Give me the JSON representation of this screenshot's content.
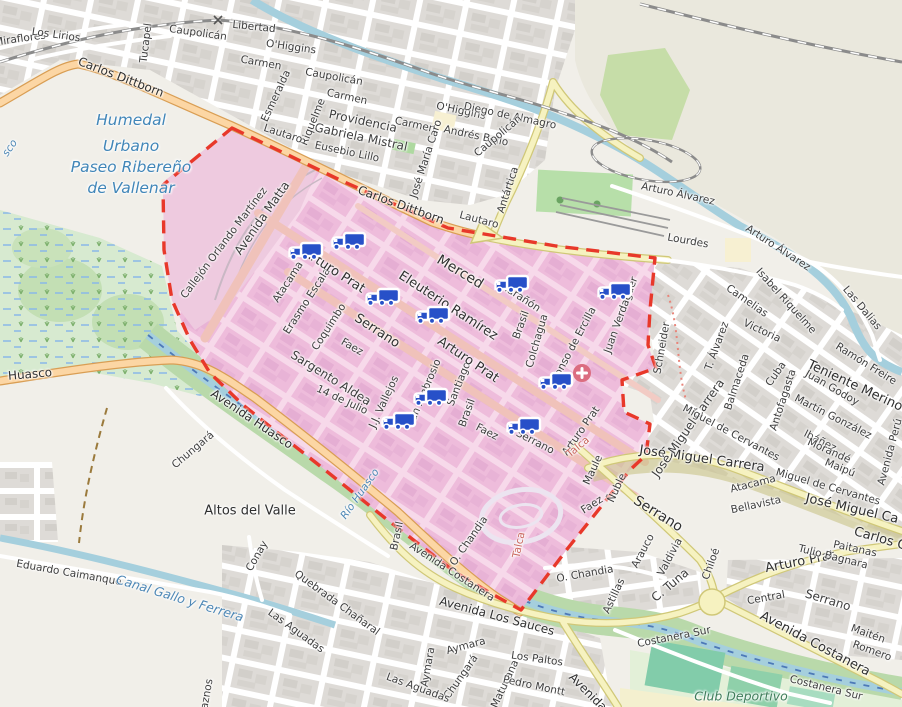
{
  "map": {
    "zone": {
      "name": "highlighted delivery zone",
      "border_color": "#e8382a",
      "fill": "#efc0da"
    },
    "icons": {
      "truck_color": "#2750c8",
      "hospital_color": "#db6d80"
    },
    "pois": [
      {
        "type": "hospital",
        "x": 582,
        "y": 373
      }
    ],
    "trucks": [
      {
        "x": 305,
        "y": 252
      },
      {
        "x": 348,
        "y": 242
      },
      {
        "x": 382,
        "y": 298
      },
      {
        "x": 432,
        "y": 316
      },
      {
        "x": 511,
        "y": 285
      },
      {
        "x": 614,
        "y": 292
      },
      {
        "x": 555,
        "y": 382
      },
      {
        "x": 430,
        "y": 398
      },
      {
        "x": 398,
        "y": 422
      },
      {
        "x": 523,
        "y": 427
      }
    ],
    "labels": [
      {
        "t": "Miraflores",
        "x": 20,
        "y": 39,
        "r": -8,
        "c": "st"
      },
      {
        "t": "Los Lirios",
        "x": 56,
        "y": 35,
        "r": 8,
        "c": "st"
      },
      {
        "t": "Carlos Dittborn",
        "x": 121,
        "y": 77,
        "r": 21,
        "c": "maj",
        "s": 12
      },
      {
        "t": "Tucapel",
        "x": 146,
        "y": 43,
        "r": -83,
        "c": "st"
      },
      {
        "t": "Caupolicán",
        "x": 198,
        "y": 33,
        "r": 8,
        "c": "st"
      },
      {
        "t": "Libertad",
        "x": 254,
        "y": 27,
        "r": 6,
        "c": "st"
      },
      {
        "t": "O'Higgins",
        "x": 291,
        "y": 47,
        "r": 8,
        "c": "st"
      },
      {
        "t": "Carmen",
        "x": 261,
        "y": 63,
        "r": 10,
        "c": "st"
      },
      {
        "t": "Esmeralda",
        "x": 276,
        "y": 96,
        "r": -65,
        "c": "st"
      },
      {
        "t": "Caupolicán",
        "x": 334,
        "y": 77,
        "r": 10,
        "c": "st"
      },
      {
        "t": "Carmen",
        "x": 347,
        "y": 97,
        "r": 12,
        "c": "st"
      },
      {
        "t": "Providencia",
        "x": 363,
        "y": 121,
        "r": 12,
        "c": "st",
        "s": 12
      },
      {
        "t": "Gabriela Mistral",
        "x": 361,
        "y": 137,
        "r": 12,
        "c": "st",
        "s": 12
      },
      {
        "t": "Eusebio Lillo",
        "x": 347,
        "y": 152,
        "r": 12,
        "c": "st"
      },
      {
        "t": "Riquelme",
        "x": 313,
        "y": 122,
        "r": -68,
        "c": "st"
      },
      {
        "t": "Carmen",
        "x": 415,
        "y": 125,
        "r": 12,
        "c": "st"
      },
      {
        "t": "José María Caro",
        "x": 426,
        "y": 159,
        "r": -72,
        "c": "st"
      },
      {
        "t": "O'Higgins",
        "x": 461,
        "y": 111,
        "r": 12,
        "c": "st"
      },
      {
        "t": "Diego de Almagro",
        "x": 510,
        "y": 116,
        "r": 12,
        "c": "st"
      },
      {
        "t": "Andrés Bello",
        "x": 476,
        "y": 136,
        "r": 12,
        "c": "st"
      },
      {
        "t": "Caupolicán",
        "x": 498,
        "y": 136,
        "r": -40,
        "c": "st"
      },
      {
        "t": "Antártica",
        "x": 508,
        "y": 190,
        "r": -72,
        "c": "st"
      },
      {
        "t": "Lautaro",
        "x": 283,
        "y": 134,
        "r": 18,
        "c": "st"
      },
      {
        "t": "Lautaro",
        "x": 479,
        "y": 220,
        "r": 15,
        "c": "st"
      },
      {
        "t": "Carlos Dittborn",
        "x": 401,
        "y": 205,
        "r": 20,
        "c": "maj",
        "s": 12
      },
      {
        "t": "Arturo Álvarez",
        "x": 678,
        "y": 194,
        "r": 12,
        "c": "st"
      },
      {
        "t": "Arturo Álvarez",
        "x": 778,
        "y": 248,
        "r": 33,
        "c": "st"
      },
      {
        "t": "Lourdes",
        "x": 688,
        "y": 241,
        "r": 10,
        "c": "st"
      },
      {
        "t": "Humedal",
        "x": 131,
        "y": 120,
        "r": 0,
        "c": "hum"
      },
      {
        "t": "Urbano",
        "x": 131,
        "y": 146,
        "r": 0,
        "c": "hum"
      },
      {
        "t": "Paseo Ribereño",
        "x": 131,
        "y": 167,
        "r": 0,
        "c": "hum"
      },
      {
        "t": "de Vallenar",
        "x": 131,
        "y": 188,
        "r": 0,
        "c": "hum"
      },
      {
        "t": "sco",
        "x": 10,
        "y": 148,
        "r": -55,
        "c": "wat"
      },
      {
        "t": "Avenida Matta",
        "x": 262,
        "y": 218,
        "r": -55,
        "c": "st",
        "s": 12
      },
      {
        "t": "Callejón Orlando Martínez",
        "x": 224,
        "y": 243,
        "r": -53,
        "c": "st",
        "s": 10.5
      },
      {
        "t": "Atacama",
        "x": 288,
        "y": 282,
        "r": -57,
        "c": "st"
      },
      {
        "t": "Erasmo Escala",
        "x": 307,
        "y": 301,
        "r": -57,
        "c": "st",
        "s": 10.5
      },
      {
        "t": "Coquimbo",
        "x": 329,
        "y": 327,
        "r": -57,
        "c": "st"
      },
      {
        "t": "Arturo Prat",
        "x": 334,
        "y": 271,
        "r": 33,
        "c": "maj"
      },
      {
        "t": "Serrano",
        "x": 377,
        "y": 331,
        "r": 33,
        "c": "maj"
      },
      {
        "t": "Faez",
        "x": 352,
        "y": 347,
        "r": 30,
        "c": "st"
      },
      {
        "t": "Sargento Aldea",
        "x": 331,
        "y": 378,
        "r": 32,
        "c": "st",
        "s": 12
      },
      {
        "t": "14 de Julio",
        "x": 342,
        "y": 400,
        "r": 25,
        "c": "st",
        "s": 10.5
      },
      {
        "t": "J.J. Vallejos",
        "x": 384,
        "y": 402,
        "r": -65,
        "c": "st"
      },
      {
        "t": "San Ambrosio",
        "x": 424,
        "y": 393,
        "r": -67,
        "c": "st"
      },
      {
        "t": "Santiago",
        "x": 459,
        "y": 384,
        "r": -68,
        "c": "st",
        "s": 10.5
      },
      {
        "t": "Merced",
        "x": 460,
        "y": 272,
        "r": 31,
        "c": "maj",
        "s": 14
      },
      {
        "t": "Eleuterio Ramírez",
        "x": 448,
        "y": 306,
        "r": 33,
        "c": "maj"
      },
      {
        "t": "Marañón",
        "x": 520,
        "y": 297,
        "r": 33,
        "c": "st",
        "s": 10.5
      },
      {
        "t": "Brasil",
        "x": 521,
        "y": 325,
        "r": -70,
        "c": "st"
      },
      {
        "t": "Brasil",
        "x": 467,
        "y": 413,
        "r": -70,
        "c": "st"
      },
      {
        "t": "Brasil",
        "x": 397,
        "y": 536,
        "r": -78,
        "c": "st"
      },
      {
        "t": "Arturo Prat",
        "x": 468,
        "y": 360,
        "r": 34,
        "c": "maj"
      },
      {
        "t": "Colchagua",
        "x": 537,
        "y": 341,
        "r": -74,
        "c": "st"
      },
      {
        "t": "Alonso de Ercilla",
        "x": 573,
        "y": 346,
        "r": -62,
        "c": "st"
      },
      {
        "t": "Juan Verdaguer",
        "x": 621,
        "y": 315,
        "r": -70,
        "c": "st"
      },
      {
        "t": "Faez",
        "x": 487,
        "y": 432,
        "r": 27,
        "c": "st"
      },
      {
        "t": "Serrano",
        "x": 535,
        "y": 442,
        "r": 27,
        "c": "st"
      },
      {
        "t": "Arturo Prat",
        "x": 581,
        "y": 431,
        "r": -55,
        "c": "st"
      },
      {
        "t": "O. Chandia",
        "x": 469,
        "y": 541,
        "r": -55,
        "c": "st"
      },
      {
        "t": "Talca",
        "x": 578,
        "y": 447,
        "r": -40,
        "c": "red"
      },
      {
        "t": "Talca",
        "x": 519,
        "y": 545,
        "r": -78,
        "c": "red"
      },
      {
        "t": "Avenida Costanera",
        "x": 452,
        "y": 572,
        "r": 33,
        "c": "st"
      },
      {
        "t": "Río Huasco",
        "x": 360,
        "y": 494,
        "r": -55,
        "c": "wat"
      },
      {
        "t": "Eduardo Caimanque",
        "x": 69,
        "y": 573,
        "r": 10,
        "c": "st"
      },
      {
        "t": "Canal Gallo y Ferrera",
        "x": 180,
        "y": 598,
        "r": 17,
        "c": "wat",
        "s": 12.5
      },
      {
        "t": "Altos del Valle",
        "x": 250,
        "y": 511,
        "r": 0,
        "c": "pl"
      },
      {
        "t": "Huasco",
        "x": 30,
        "y": 374,
        "r": -5,
        "c": "maj",
        "s": 12
      },
      {
        "t": "Avenida Huasco",
        "x": 252,
        "y": 419,
        "r": 34,
        "c": "maj",
        "s": 12
      },
      {
        "t": "Chungará",
        "x": 193,
        "y": 450,
        "r": -40,
        "c": "st"
      },
      {
        "t": "Chungará",
        "x": 461,
        "y": 677,
        "r": -55,
        "c": "st"
      },
      {
        "t": "Conay",
        "x": 257,
        "y": 556,
        "r": -60,
        "c": "st"
      },
      {
        "t": "Quebrada Chañaral",
        "x": 337,
        "y": 603,
        "r": 36,
        "c": "st"
      },
      {
        "t": "Las Aguadas",
        "x": 296,
        "y": 631,
        "r": 36,
        "c": "st"
      },
      {
        "t": "Las Aguadas",
        "x": 418,
        "y": 688,
        "r": 20,
        "c": "st"
      },
      {
        "t": "aznos",
        "x": 207,
        "y": 694,
        "r": -80,
        "c": "st"
      },
      {
        "t": "Aymara",
        "x": 466,
        "y": 646,
        "r": -15,
        "c": "st"
      },
      {
        "t": "Aymara",
        "x": 428,
        "y": 667,
        "r": -80,
        "c": "st"
      },
      {
        "t": "Matucana",
        "x": 505,
        "y": 684,
        "r": -65,
        "c": "st"
      },
      {
        "t": "Pedro Montt",
        "x": 534,
        "y": 686,
        "r": 12,
        "c": "st"
      },
      {
        "t": "Los Paltos",
        "x": 537,
        "y": 659,
        "r": 8,
        "c": "st"
      },
      {
        "t": "Avenida Los Sauces",
        "x": 497,
        "y": 616,
        "r": 15,
        "c": "maj",
        "s": 12
      },
      {
        "t": "Avenida",
        "x": 588,
        "y": 692,
        "r": 45,
        "c": "maj",
        "s": 12
      },
      {
        "t": "O. Chandia",
        "x": 585,
        "y": 574,
        "r": -10,
        "c": "st"
      },
      {
        "t": "Astillas",
        "x": 614,
        "y": 596,
        "r": -65,
        "c": "st"
      },
      {
        "t": "C. Tuna",
        "x": 670,
        "y": 585,
        "r": -40,
        "c": "st",
        "s": 12
      },
      {
        "t": "Arauco",
        "x": 643,
        "y": 551,
        "r": -62,
        "c": "st"
      },
      {
        "t": "Valdivia",
        "x": 670,
        "y": 557,
        "r": -62,
        "c": "st"
      },
      {
        "t": "Chiloé",
        "x": 711,
        "y": 564,
        "r": -70,
        "c": "st"
      },
      {
        "t": "Maule",
        "x": 593,
        "y": 470,
        "r": -65,
        "c": "st"
      },
      {
        "t": "Ñuble",
        "x": 617,
        "y": 488,
        "r": -65,
        "c": "st"
      },
      {
        "t": "Faez",
        "x": 592,
        "y": 505,
        "r": -33,
        "c": "st"
      },
      {
        "t": "Serrano",
        "x": 658,
        "y": 514,
        "r": 32,
        "c": "maj",
        "s": 14
      },
      {
        "t": "Atacama",
        "x": 753,
        "y": 484,
        "r": -14,
        "c": "st"
      },
      {
        "t": "Bellavista",
        "x": 756,
        "y": 505,
        "r": -12,
        "c": "st"
      },
      {
        "t": "José Miguel Carrera",
        "x": 702,
        "y": 459,
        "r": 8,
        "c": "maj"
      },
      {
        "t": "José Miguel Ca",
        "x": 852,
        "y": 509,
        "r": 13,
        "c": "maj"
      },
      {
        "t": "Carlos Co",
        "x": 884,
        "y": 540,
        "r": 16,
        "c": "maj"
      },
      {
        "t": "Arturo Prat",
        "x": 800,
        "y": 562,
        "r": -11,
        "c": "maj"
      },
      {
        "t": "Tulio Bagnara",
        "x": 833,
        "y": 557,
        "r": 14,
        "c": "st"
      },
      {
        "t": "Paitanas",
        "x": 855,
        "y": 549,
        "r": 12,
        "c": "st"
      },
      {
        "t": "Serrano",
        "x": 828,
        "y": 600,
        "r": 17,
        "c": "st",
        "s": 12
      },
      {
        "t": "Central",
        "x": 766,
        "y": 598,
        "r": -10,
        "c": "st"
      },
      {
        "t": "Maitén",
        "x": 868,
        "y": 634,
        "r": 20,
        "c": "st"
      },
      {
        "t": "Romero",
        "x": 872,
        "y": 651,
        "r": 20,
        "c": "st"
      },
      {
        "t": "Avenida Costanera",
        "x": 815,
        "y": 644,
        "r": 28,
        "c": "maj"
      },
      {
        "t": "Costanera Sur",
        "x": 674,
        "y": 637,
        "r": -11,
        "c": "st"
      },
      {
        "t": "Costanera Sur",
        "x": 826,
        "y": 688,
        "r": 14,
        "c": "st"
      },
      {
        "t": "Club Deportivo",
        "x": 741,
        "y": 696,
        "r": 0,
        "c": "lei"
      },
      {
        "t": "Schneider",
        "x": 662,
        "y": 348,
        "r": -80,
        "c": "st"
      },
      {
        "t": "José Miguel Carrera",
        "x": 688,
        "y": 428,
        "r": -55,
        "c": "st",
        "s": 12
      },
      {
        "t": "T. Álvarez",
        "x": 717,
        "y": 346,
        "r": -70,
        "c": "st"
      },
      {
        "t": "Camelias",
        "x": 747,
        "y": 301,
        "r": 35,
        "c": "st"
      },
      {
        "t": "Victoria",
        "x": 762,
        "y": 331,
        "r": 25,
        "c": "st"
      },
      {
        "t": "Isabel Riquelme",
        "x": 786,
        "y": 301,
        "r": 48,
        "c": "st"
      },
      {
        "t": "Las Dalias",
        "x": 862,
        "y": 308,
        "r": 50,
        "c": "st"
      },
      {
        "t": "Ramón Freire",
        "x": 866,
        "y": 364,
        "r": 32,
        "c": "st"
      },
      {
        "t": "Teniente Merino",
        "x": 855,
        "y": 386,
        "r": 25,
        "c": "maj"
      },
      {
        "t": "Balmaceda",
        "x": 737,
        "y": 382,
        "r": -72,
        "c": "st"
      },
      {
        "t": "Cuba",
        "x": 776,
        "y": 374,
        "r": -55,
        "c": "st"
      },
      {
        "t": "Antofagasta",
        "x": 783,
        "y": 400,
        "r": -72,
        "c": "st"
      },
      {
        "t": "Juan Godoy",
        "x": 832,
        "y": 388,
        "r": 30,
        "c": "st"
      },
      {
        "t": "Martín González",
        "x": 833,
        "y": 417,
        "r": 27,
        "c": "st"
      },
      {
        "t": "Ibáñez",
        "x": 820,
        "y": 441,
        "r": 27,
        "c": "st"
      },
      {
        "t": "Morandé",
        "x": 829,
        "y": 451,
        "r": 24,
        "c": "st"
      },
      {
        "t": "Maipú",
        "x": 840,
        "y": 468,
        "r": 22,
        "c": "st"
      },
      {
        "t": "Miguel de Cervantes",
        "x": 828,
        "y": 487,
        "r": 16,
        "c": "st"
      },
      {
        "t": "Miguel de Cervantes",
        "x": 731,
        "y": 433,
        "r": 28,
        "c": "st"
      },
      {
        "t": "Avenida Perú",
        "x": 890,
        "y": 452,
        "r": -75,
        "c": "st"
      }
    ]
  }
}
